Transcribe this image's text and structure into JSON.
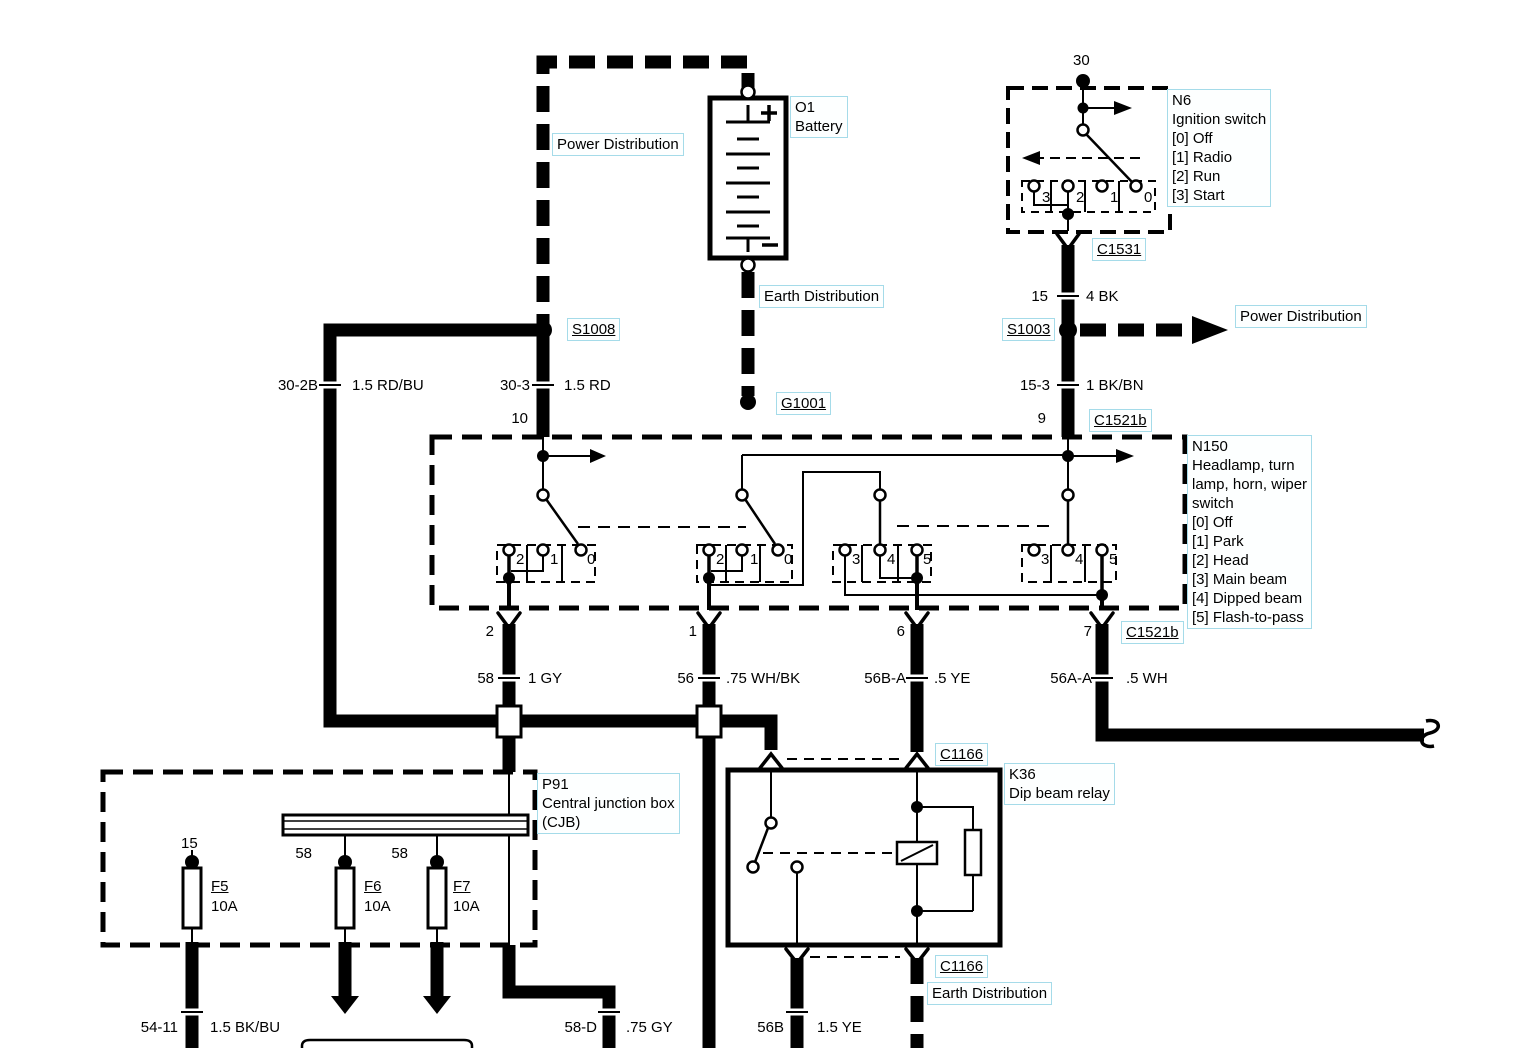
{
  "diagram": {
    "accent_label_border": "#a5dbe9",
    "label_background": "#fdffff",
    "line_color": "#000000"
  },
  "power": {
    "top_label": "Power Distribution",
    "right_label": "Power Distribution"
  },
  "battery": {
    "id": "O1",
    "name": "Battery",
    "plus": "+",
    "minus": "−"
  },
  "earth": {
    "top_label": "Earth Distribution",
    "bottom_label": "Earth Distribution"
  },
  "ground": {
    "id": "G1001"
  },
  "splices": {
    "s1008": "S1008",
    "s1003": "S1003"
  },
  "ignition": {
    "id": "N6",
    "name": "Ignition switch",
    "positions": [
      "[0] Off",
      "[1] Radio",
      "[2] Run",
      "[3] Start"
    ],
    "terminal": "30",
    "contacts": [
      "3",
      "2",
      "1",
      "0"
    ],
    "connector": "C1531"
  },
  "n150": {
    "id": "N150",
    "desc": [
      "Headlamp, turn",
      "lamp, horn, wiper",
      "switch"
    ],
    "positions": [
      "[0] Off",
      "[1] Park",
      "[2] Head",
      "[3] Main beam",
      "[4] Dipped beam",
      "[5] Flash-to-pass"
    ],
    "pin_in_left": "10",
    "pin_in_right": "9",
    "pins_out": [
      "2",
      "1",
      "6",
      "7"
    ],
    "group_a": [
      "2",
      "1",
      "0"
    ],
    "group_b": [
      "2",
      "1",
      "0"
    ],
    "group_c": [
      "3",
      "4",
      "5"
    ],
    "group_d": [
      "3",
      "4",
      "5"
    ],
    "connector_top": "C1521b",
    "connector_bottom": "C1521b"
  },
  "cjb": {
    "id": "P91",
    "desc": [
      "Central junction box",
      "(CJB)"
    ],
    "f5": "F5",
    "f5_rating": "10A",
    "f5_feed": "15",
    "f6": "F6",
    "f6_rating": "10A",
    "f6_feed": "58",
    "f7": "F7",
    "f7_rating": "10A",
    "f7_feed": "58"
  },
  "relay": {
    "id": "K36",
    "name": "Dip beam relay",
    "connector_top": "C1166",
    "connector_bottom": "C1166"
  },
  "wires": {
    "w30_2b": {
      "id": "30-2B",
      "spec": "1.5 RD/BU"
    },
    "w30_3": {
      "id": "30-3",
      "spec": "1.5 RD"
    },
    "w15": {
      "id": "15",
      "spec": "4 BK"
    },
    "w15_3": {
      "id": "15-3",
      "spec": "1 BK/BN"
    },
    "w58": {
      "id": "58",
      "spec": "1 GY"
    },
    "w56": {
      "id": "56",
      "spec": ".75 WH/BK"
    },
    "w56b_a": {
      "id": "56B-A",
      "spec": ".5 YE"
    },
    "w56a_a": {
      "id": "56A-A",
      "spec": ".5 WH"
    },
    "w54_11": {
      "id": "54-11",
      "spec": "1.5 BK/BU"
    },
    "w58_d": {
      "id": "58-D",
      "spec": ".75 GY"
    },
    "w56b": {
      "id": "56B",
      "spec": "1.5 YE"
    }
  }
}
